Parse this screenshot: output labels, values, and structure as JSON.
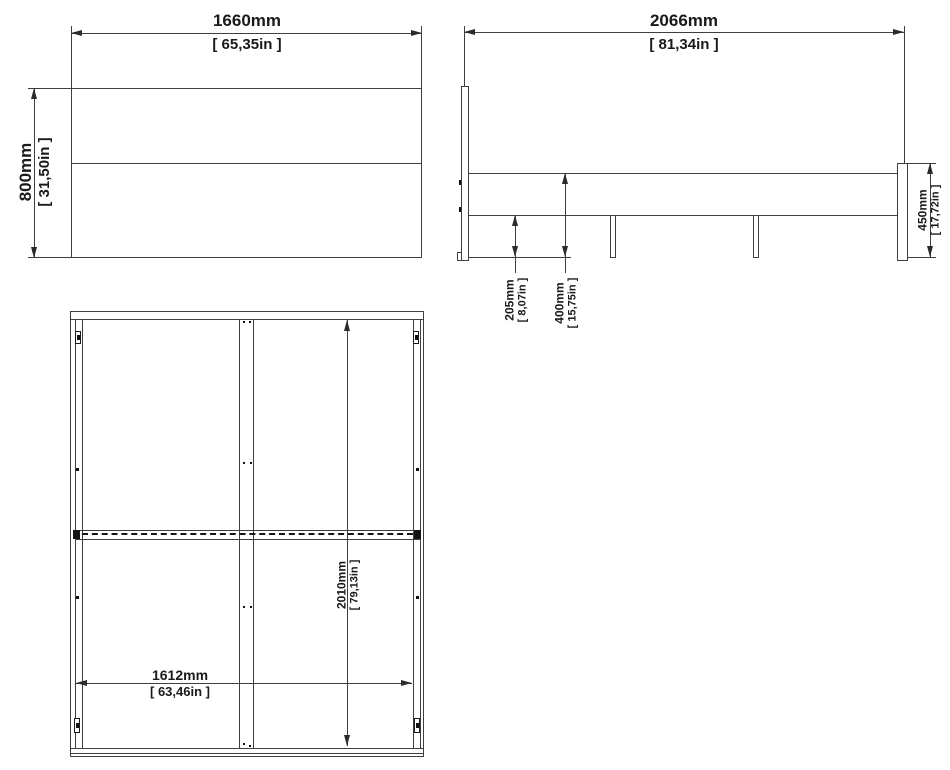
{
  "colors": {
    "line": "#3f3f3f",
    "text": "#1a1a1a",
    "background": "#ffffff"
  },
  "views": {
    "headboard_front": {
      "title": "headboard-front-view",
      "width_mm": "1660mm",
      "width_in": "[ 65,35in ]",
      "height_mm": "800mm",
      "height_in": "[ 31,50in ]"
    },
    "side": {
      "title": "side-view",
      "length_mm": "2066mm",
      "length_in": "[ 81,34in ]",
      "slat_clearance_mm": "205mm",
      "slat_clearance_in": "[ 8,07in ]",
      "rail_top_height_mm": "400mm",
      "rail_top_height_in": "[ 15,75in ]",
      "footboard_height_mm": "450mm",
      "footboard_height_in": "[ 17,72in ]"
    },
    "top": {
      "title": "top-view",
      "inner_width_mm": "1612mm",
      "inner_width_in": "[ 63,46in ]",
      "inner_length_mm": "2010mm",
      "inner_length_in": "[ 79,13in ]"
    }
  }
}
